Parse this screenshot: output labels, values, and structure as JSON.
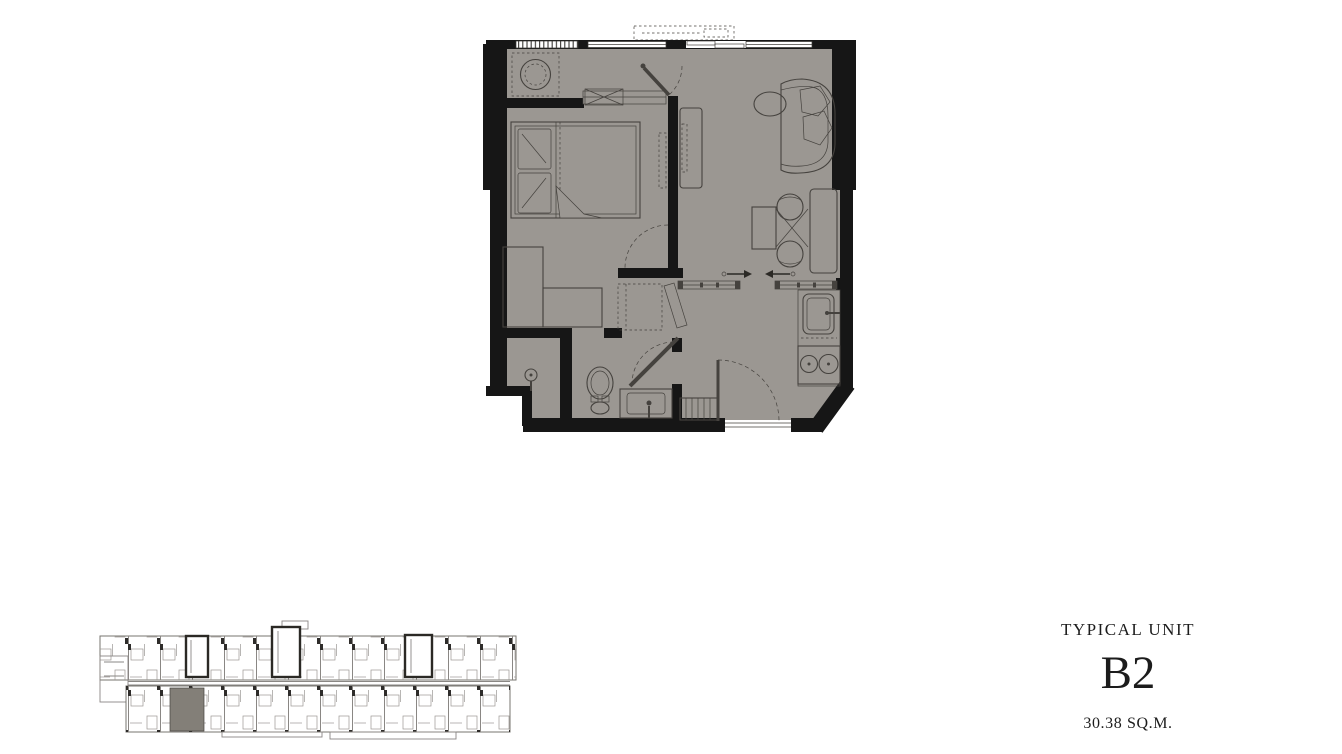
{
  "unit_info": {
    "label": "TYPICAL UNIT",
    "unit_code": "B2",
    "area": "30.38 SQ.M."
  },
  "colors": {
    "floor": "#9b9792",
    "wall": "#161616",
    "line": "#45423e",
    "keyplan_line": "#8a8784",
    "keyplan_highlight": "#837f78"
  },
  "floorplan": {
    "name": "unit-b2-floor-plan",
    "rooms": [
      "bedroom",
      "living-dining",
      "kitchen",
      "bathroom",
      "wardrobe-corridor",
      "washer-nook",
      "entrance"
    ],
    "furniture": [
      "washing-machine",
      "double-bed",
      "pillows",
      "tv",
      "tv-console",
      "sofa",
      "side-table",
      "dining-table",
      "dining-chairs",
      "counter",
      "sliding-doors",
      "kitchen-sink",
      "stove",
      "shoe-cabinet",
      "entrance-door",
      "toilet",
      "bathroom-sink",
      "shower",
      "wardrobe",
      "dressing-table"
    ]
  },
  "keyplan": {
    "name": "building-key-plan",
    "highlighted_unit": "B2"
  }
}
